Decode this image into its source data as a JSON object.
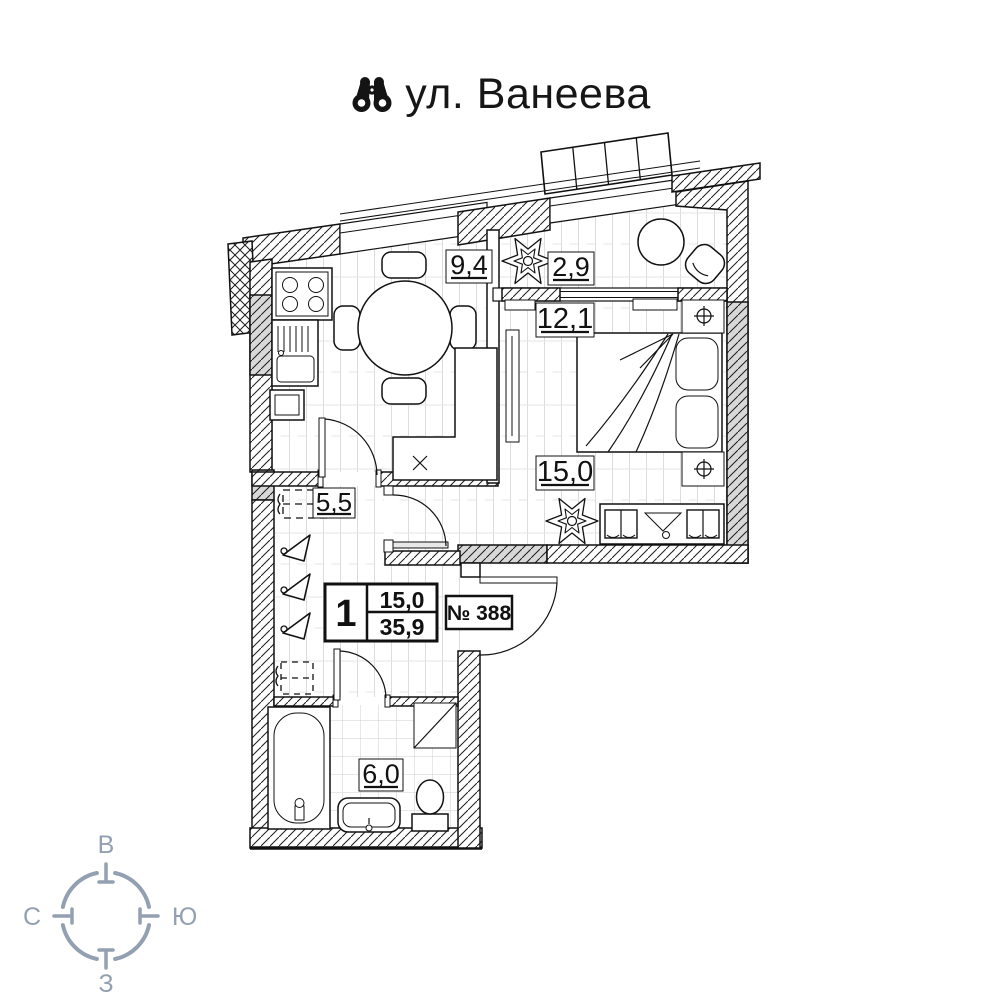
{
  "header": {
    "title": "ул. Ванеева",
    "icon": "binoculars-icon"
  },
  "plan": {
    "room_areas": {
      "kitchen": "9,4",
      "balcony": "2,9",
      "bedroom_upper": "12,1",
      "living_room": "15,0",
      "hallway": "5,5",
      "bathroom": "6,0"
    },
    "info_box": {
      "rooms_count": "1",
      "living_area": "15,0",
      "total_area": "35,9"
    },
    "apartment_number": "№ 388",
    "colors": {
      "wall_line": "#111111",
      "gray_fill": "#d8d8d8",
      "floor_line": "#dcdcdc"
    }
  },
  "compass": {
    "top": "В",
    "right": "Ю",
    "left": "С",
    "bottom": "З",
    "color": "#93a0b1"
  }
}
